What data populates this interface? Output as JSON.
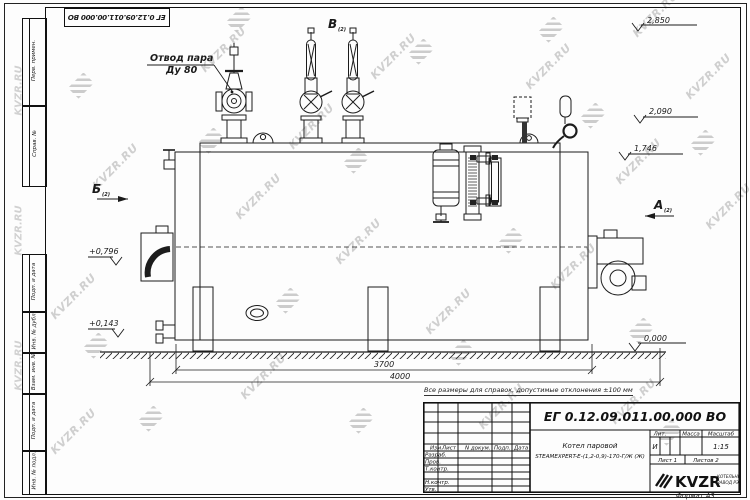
{
  "watermark": {
    "text": "KVZR.RU"
  },
  "corner_stamp": {
    "code": "ЕГ 0.12.09.011.00.000  ВО"
  },
  "frame_columns": {
    "top": [
      "Перв. примен.",
      "Справ. №"
    ],
    "bottom": [
      "Подп. и дата",
      "Инв. № дубл.",
      "Взам. инв. №",
      "Подп. и дата",
      "Инв. № подл."
    ]
  },
  "note": "Все размеры для справок, допустимые отклонения ±100 мм",
  "drawing": {
    "callout": {
      "line1": "Отвод пара",
      "line2": "Ду 80"
    },
    "views": {
      "top": "В",
      "left": "Б",
      "right": "А",
      "ref": "(2)"
    },
    "elevations": {
      "top_valves": "2,850",
      "gauge": "2,090",
      "shell_top": "1,746",
      "duct": "+0,796",
      "lower": "+0,143",
      "ground": "0,000"
    },
    "dimensions": {
      "body_length": "3700",
      "overall_length": "4000"
    }
  },
  "title_block": {
    "doc_code": "ЕГ 0.12.09.011.00.000  ВО",
    "name_line1": "Котел паровой",
    "name_line2": "STEAMEXPERT-Е-(1,2-0,9)-170-Г/Ж (Ж)",
    "columns": [
      "Изм.",
      "Лист",
      "N докум.",
      "Подп.",
      "Дата"
    ],
    "rows": [
      "Разраб.",
      "Пров.",
      "Т.контр.",
      "Н.контр.",
      "Утв."
    ],
    "lit_label": "Лит.",
    "lit_value": "И",
    "mass_label": "Масса",
    "scale_label": "Масштаб",
    "scale_value": "1:15",
    "sheet": "Лист 1",
    "sheets": "Листов 2",
    "brand": "KVZR",
    "brand_line1": "КОТЕЛЬНЫЙ",
    "brand_line2": "ЗАВОД РЭ",
    "format": "Формат А3"
  }
}
